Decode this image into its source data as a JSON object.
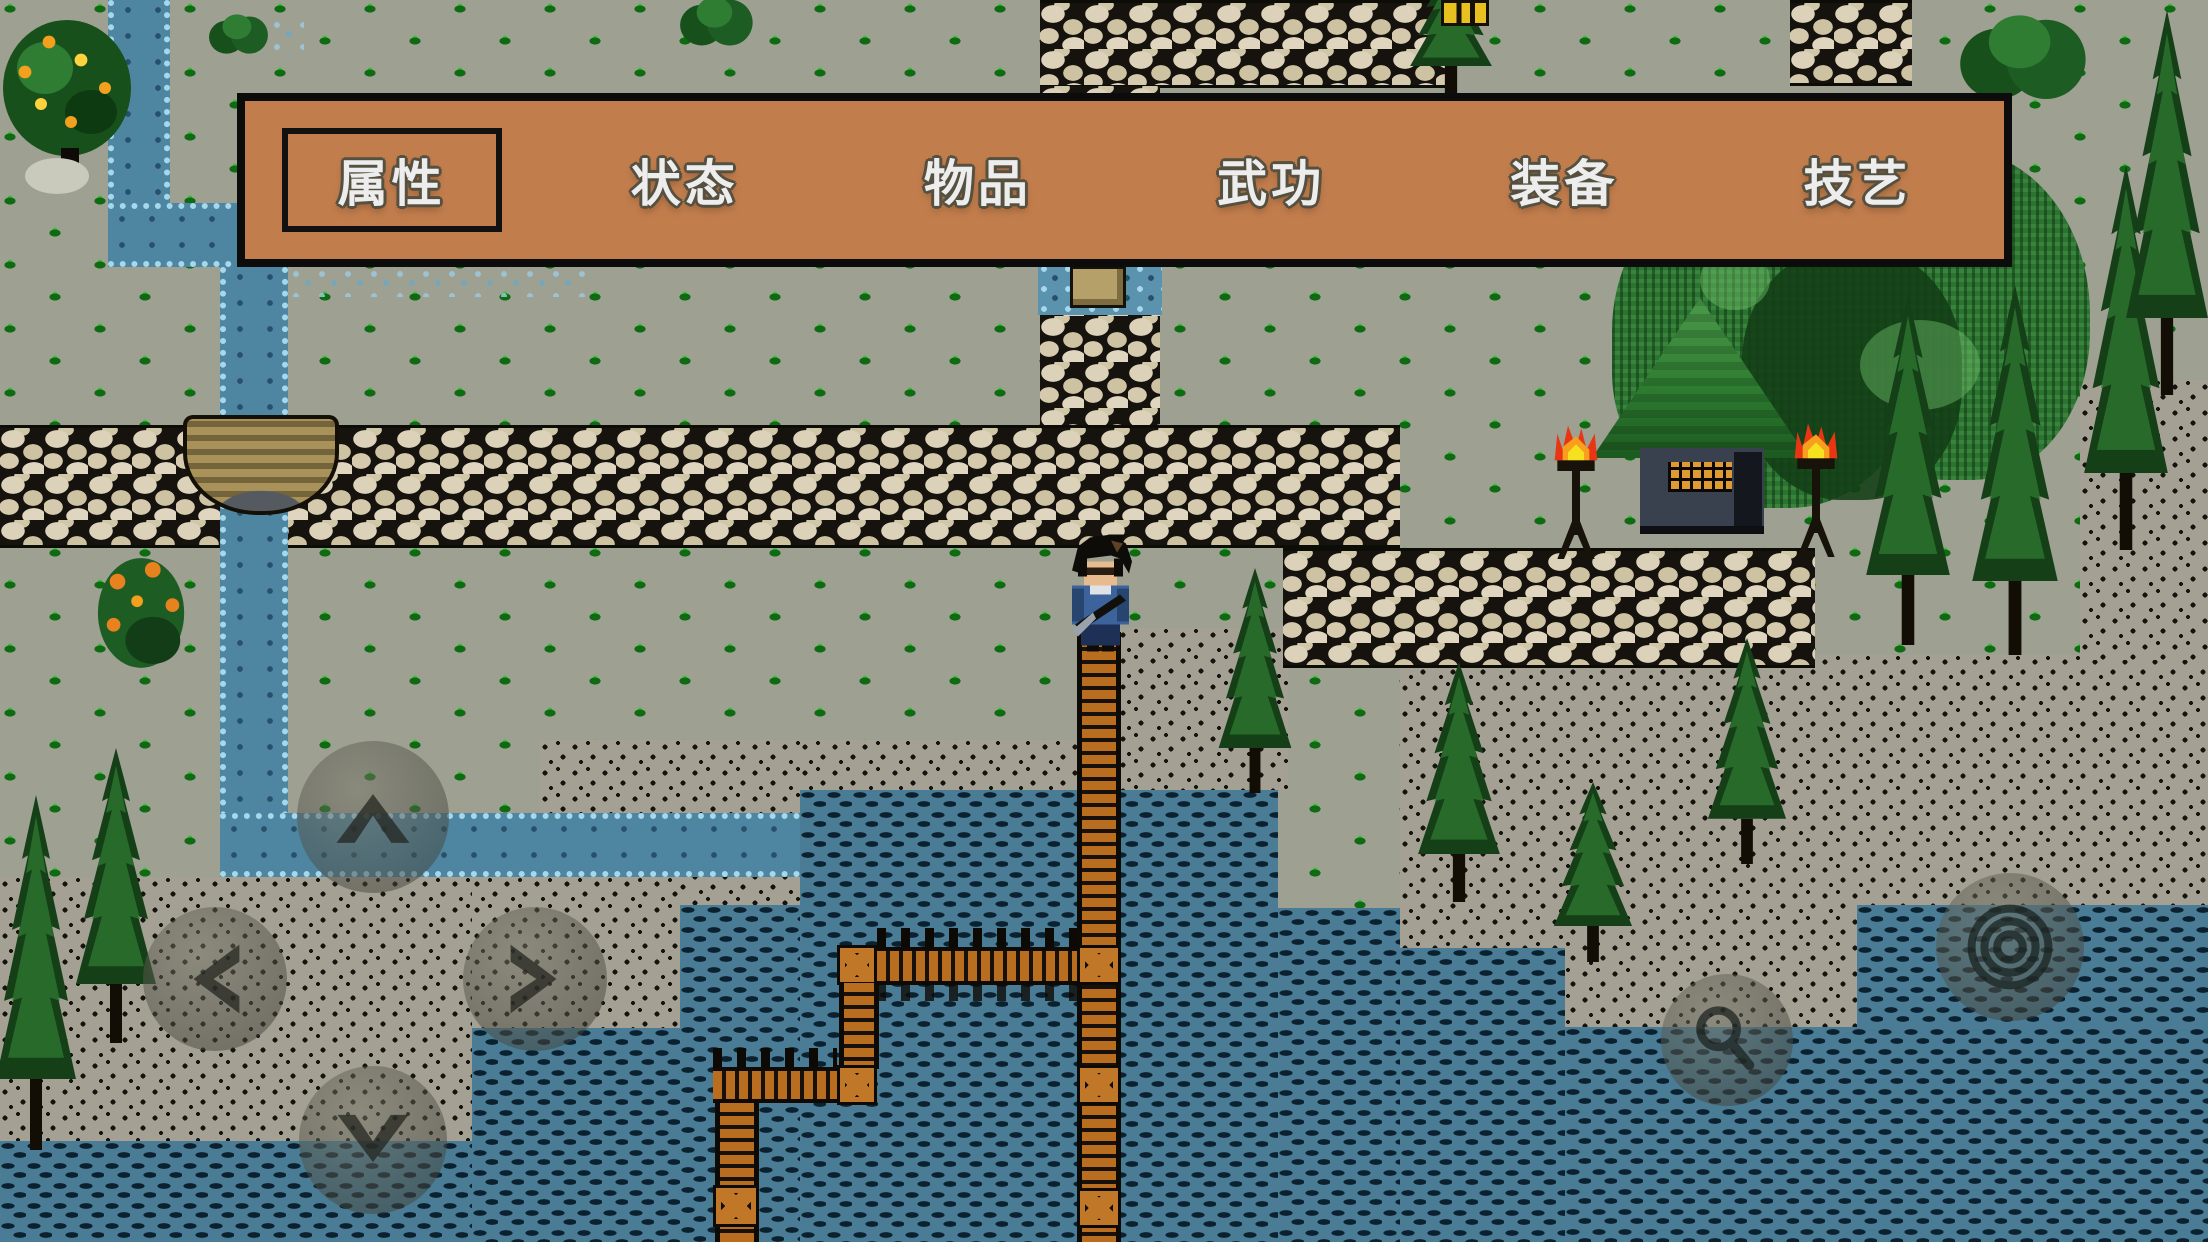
{
  "menu": {
    "selected_index": 0,
    "items": [
      {
        "label": "属性"
      },
      {
        "label": "状态"
      },
      {
        "label": "物品"
      },
      {
        "label": "武功"
      },
      {
        "label": "装备"
      },
      {
        "label": "技艺"
      }
    ]
  },
  "touch_controls": {
    "dpad_up": "up-arrow",
    "dpad_left": "left-arrow",
    "dpad_right": "right-arrow",
    "dpad_down": "down-arrow",
    "action_primary": "interact-ring",
    "action_secondary": "rope-coil"
  },
  "scene": {
    "terrain": [
      "grass",
      "speckled-dirt",
      "cobblestone-road",
      "stream",
      "lake",
      "wooden-pier",
      "fence"
    ],
    "props": [
      "stone-bridge",
      "thatched-hut",
      "torches",
      "pine-trees",
      "fruit-tree",
      "flower-bush",
      "spring-well",
      "player-character"
    ]
  },
  "palette": {
    "menu_bg": "#C27D4D",
    "menu_border": "#0C0C0C",
    "menu_text": "#EDEDED",
    "grass_base": "#9EA092",
    "tuft_green": "#3CC13C",
    "stone_light": "#D8CDB2",
    "water_teal": "#4A7D95",
    "stream_blue": "#4E86A1",
    "pier_wood": "#B96D1E",
    "flame_red": "#E83614",
    "roof_green": "#2E7D31"
  }
}
